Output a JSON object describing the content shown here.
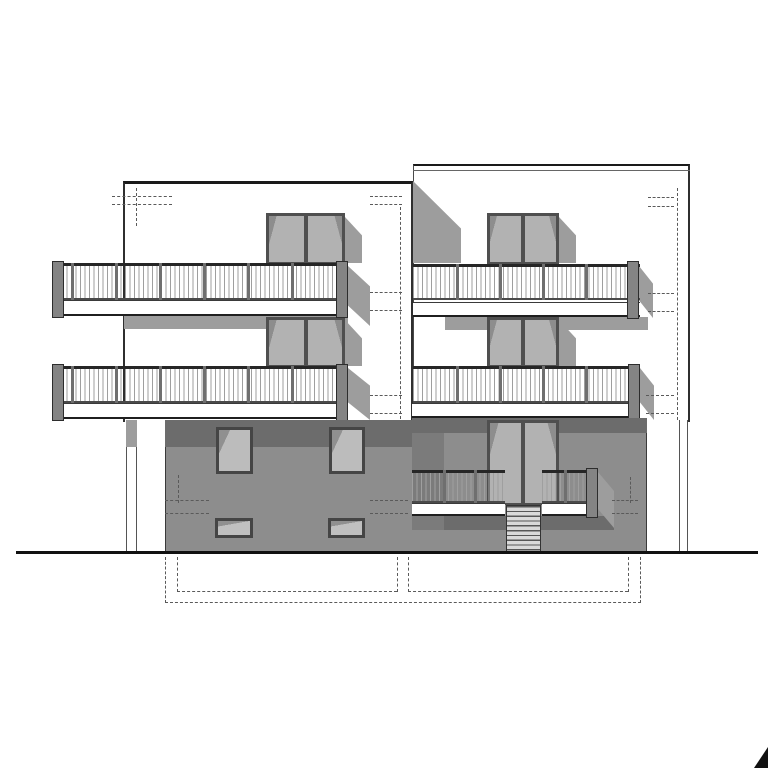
{
  "document": {
    "type": "architectural-elevation-drawing",
    "description": "Black-and-white front elevation of a three-storey duplex building: two white upper volumes with continuous balconies and double doors, a recessed gray ground storey with windows, central entrance stair with railings, cast shadows, dashed hidden-line marks, ground line and dashed basement outline, black corner mark bottom-right.",
    "visible_text": []
  },
  "colors": {
    "background": "#ffffff",
    "line": "#1a1a1a",
    "shadow": "#9d9d9d",
    "shadow_dark": "#6c6c6c",
    "wall_gray": "#8d8d8d",
    "glass_gray": "#b8b8b8",
    "frame_gray": "#4f4f4f"
  },
  "inventory": {
    "volumes": 2,
    "balcony_doors": 4,
    "entrance_doors": 1,
    "balconies": 4,
    "ground_windows": 4,
    "stair_steps": 10,
    "support_columns": 2
  },
  "scene": [
    {
      "name": "right-facade",
      "cls": "facade-right",
      "rect": [
        413,
        164,
        277,
        258
      ]
    },
    {
      "name": "right-parapet-line",
      "cls": "hline1",
      "rect": [
        413,
        170,
        277,
        0
      ]
    },
    {
      "name": "left-facade",
      "cls": "facade-left",
      "rect": [
        123,
        181,
        290,
        241
      ]
    },
    {
      "name": "volume-joint-shadow",
      "cls": "shadow9 clipJoint",
      "rect": [
        413,
        181,
        48,
        82
      ]
    },
    {
      "name": "underbalcony-shadow-2f-left",
      "cls": "shadow9",
      "rect": [
        124,
        316,
        224,
        13
      ]
    },
    {
      "name": "underbalcony-shadow-2f-right",
      "cls": "shadow9",
      "rect": [
        445,
        317,
        203,
        13
      ]
    },
    {
      "name": "door-shadow-2f-left",
      "cls": "shadow9 clipA",
      "rect": [
        345,
        217,
        17,
        46
      ]
    },
    {
      "name": "door-shadow-2f-right",
      "cls": "shadow9 clipA",
      "rect": [
        559,
        217,
        17,
        46
      ]
    },
    {
      "name": "door-shadow-1f-left",
      "cls": "shadow9 clipA",
      "rect": [
        345,
        320,
        17,
        46
      ]
    },
    {
      "name": "door-shadow-1f-right",
      "cls": "shadow9 clipA",
      "rect": [
        559,
        320,
        17,
        46
      ]
    },
    {
      "name": "balcony-door-2f-left",
      "cls": "door",
      "rect": [
        266,
        213,
        79,
        51
      ]
    },
    {
      "name": "balcony-door-2f-right",
      "cls": "door",
      "rect": [
        487,
        213,
        72,
        51
      ]
    },
    {
      "name": "balcony-door-1f-left",
      "cls": "door",
      "rect": [
        266,
        317,
        79,
        50
      ]
    },
    {
      "name": "balcony-door-1f-right",
      "cls": "door",
      "rect": [
        487,
        317,
        72,
        50
      ]
    },
    {
      "name": "balcony-end-shadow-2f-left",
      "cls": "shadow9 clipB",
      "rect": [
        348,
        266,
        22,
        60
      ]
    },
    {
      "name": "balcony-end-shadow-1f-left",
      "cls": "shadow9 clipB",
      "rect": [
        348,
        368,
        22,
        52
      ]
    },
    {
      "name": "balcony-end-shadow-2f-right",
      "cls": "shadow9 clipB",
      "rect": [
        639,
        266,
        14,
        52
      ]
    },
    {
      "name": "balcony-end-shadow-1f-right",
      "cls": "shadow9 clipB",
      "rect": [
        640,
        368,
        14,
        52
      ]
    },
    {
      "name": "balcony-fascia-2f-left",
      "cls": "fascia",
      "rect": [
        53,
        300,
        295,
        16
      ]
    },
    {
      "name": "balcony-railing-2f-left",
      "cls": "railing",
      "rect": [
        53,
        263,
        295,
        37
      ]
    },
    {
      "name": "railing-post",
      "cls": "post",
      "rect": [
        71,
        263,
        3,
        37
      ]
    },
    {
      "name": "railing-post",
      "cls": "post",
      "rect": [
        115,
        263,
        3,
        37
      ]
    },
    {
      "name": "railing-post",
      "cls": "post",
      "rect": [
        159,
        263,
        3,
        37
      ]
    },
    {
      "name": "railing-post",
      "cls": "post",
      "rect": [
        203,
        263,
        3,
        37
      ]
    },
    {
      "name": "railing-post",
      "cls": "post",
      "rect": [
        247,
        263,
        3,
        37
      ]
    },
    {
      "name": "railing-post",
      "cls": "post",
      "rect": [
        291,
        263,
        3,
        37
      ]
    },
    {
      "name": "balcony-endpost-2f-left-a",
      "cls": "endpost",
      "rect": [
        52,
        261,
        12,
        57
      ]
    },
    {
      "name": "balcony-endpost-2f-left-b",
      "cls": "endpost",
      "rect": [
        336,
        261,
        12,
        57
      ]
    },
    {
      "name": "balcony-fascia-1f-left",
      "cls": "fascia",
      "rect": [
        53,
        403,
        295,
        16
      ]
    },
    {
      "name": "balcony-railing-1f-left",
      "cls": "railing",
      "rect": [
        53,
        366,
        295,
        37
      ]
    },
    {
      "name": "railing-post",
      "cls": "post",
      "rect": [
        71,
        366,
        3,
        37
      ]
    },
    {
      "name": "railing-post",
      "cls": "post",
      "rect": [
        115,
        366,
        3,
        37
      ]
    },
    {
      "name": "railing-post",
      "cls": "post",
      "rect": [
        159,
        366,
        3,
        37
      ]
    },
    {
      "name": "railing-post",
      "cls": "post",
      "rect": [
        203,
        366,
        3,
        37
      ]
    },
    {
      "name": "railing-post",
      "cls": "post",
      "rect": [
        247,
        366,
        3,
        37
      ]
    },
    {
      "name": "railing-post",
      "cls": "post",
      "rect": [
        291,
        366,
        3,
        37
      ]
    },
    {
      "name": "balcony-endpost-1f-left-a",
      "cls": "endpost",
      "rect": [
        52,
        364,
        12,
        57
      ]
    },
    {
      "name": "balcony-endpost-1f-left-b",
      "cls": "endpost",
      "rect": [
        336,
        364,
        12,
        57
      ]
    },
    {
      "name": "balcony-fascia-2f-right",
      "cls": "fascia",
      "rect": [
        413,
        302,
        227,
        15
      ]
    },
    {
      "name": "balcony-railing-2f-right",
      "cls": "railing",
      "rect": [
        413,
        264,
        227,
        36
      ]
    },
    {
      "name": "railing-post",
      "cls": "post",
      "rect": [
        456,
        264,
        3,
        36
      ]
    },
    {
      "name": "railing-post",
      "cls": "post",
      "rect": [
        499,
        264,
        3,
        36
      ]
    },
    {
      "name": "railing-post",
      "cls": "post",
      "rect": [
        542,
        264,
        3,
        36
      ]
    },
    {
      "name": "railing-post",
      "cls": "post",
      "rect": [
        585,
        264,
        3,
        36
      ]
    },
    {
      "name": "balcony-endpost-2f-right",
      "cls": "endpost",
      "rect": [
        627,
        261,
        12,
        58
      ]
    },
    {
      "name": "balcony-fascia-1f-right",
      "cls": "fascia",
      "rect": [
        412,
        403,
        228,
        15
      ]
    },
    {
      "name": "balcony-railing-1f-right",
      "cls": "railing",
      "rect": [
        413,
        366,
        227,
        37
      ]
    },
    {
      "name": "railing-post",
      "cls": "post",
      "rect": [
        456,
        366,
        3,
        37
      ]
    },
    {
      "name": "railing-post",
      "cls": "post",
      "rect": [
        499,
        366,
        3,
        37
      ]
    },
    {
      "name": "railing-post",
      "cls": "post",
      "rect": [
        542,
        366,
        3,
        37
      ]
    },
    {
      "name": "railing-post",
      "cls": "post",
      "rect": [
        585,
        366,
        3,
        37
      ]
    },
    {
      "name": "balcony-endpost-1f-right",
      "cls": "endpost",
      "rect": [
        628,
        364,
        12,
        57
      ]
    },
    {
      "name": "ground-wall-left",
      "cls": "wallgray edgeL",
      "rect": [
        165,
        420,
        247,
        133
      ]
    },
    {
      "name": "ground-wall-left-shadowband",
      "cls": "banddark",
      "rect": [
        165,
        420,
        247,
        27
      ]
    },
    {
      "name": "support-column-left",
      "cls": "column",
      "rect": [
        126,
        420,
        11,
        133
      ]
    },
    {
      "name": "support-column-shadow",
      "cls": "shadow9",
      "rect": [
        126,
        420,
        11,
        27
      ]
    },
    {
      "name": "ground-wall-right",
      "cls": "wallgray edgeR",
      "rect": [
        412,
        418,
        235,
        135
      ]
    },
    {
      "name": "ground-wall-right-shadowband",
      "cls": "banddark",
      "rect": [
        412,
        418,
        235,
        15
      ]
    },
    {
      "name": "ground-wall-right-sidestrip",
      "cls": "bandmid",
      "rect": [
        412,
        433,
        32,
        97
      ]
    },
    {
      "name": "underlanding-shadow",
      "cls": "banddark",
      "rect": [
        444,
        516,
        170,
        14
      ]
    },
    {
      "name": "ground-window-left-a",
      "cls": "window",
      "rect": [
        216,
        427,
        37,
        47
      ]
    },
    {
      "name": "ground-window-left-b",
      "cls": "window",
      "rect": [
        329,
        427,
        36,
        47
      ]
    },
    {
      "name": "basement-window-left-a",
      "cls": "windowsm",
      "rect": [
        215,
        518,
        38,
        20
      ]
    },
    {
      "name": "basement-window-left-b",
      "cls": "windowsm",
      "rect": [
        328,
        518,
        37,
        20
      ]
    },
    {
      "name": "entrance-door",
      "cls": "door",
      "rect": [
        487,
        420,
        72,
        85
      ]
    },
    {
      "name": "entrance-stairs",
      "cls": "stairs",
      "rect": [
        506,
        505,
        35,
        48
      ]
    },
    {
      "name": "entry-fascia-left",
      "cls": "fascia",
      "rect": [
        412,
        503,
        93,
        13
      ]
    },
    {
      "name": "entry-railing-left",
      "cls": "railing",
      "rect": [
        412,
        470,
        93,
        33
      ]
    },
    {
      "name": "railing-post",
      "cls": "post",
      "rect": [
        443,
        470,
        3,
        33
      ]
    },
    {
      "name": "railing-post",
      "cls": "post",
      "rect": [
        474,
        470,
        3,
        33
      ]
    },
    {
      "name": "entry-fascia-right",
      "cls": "fascia",
      "rect": [
        542,
        503,
        56,
        13
      ]
    },
    {
      "name": "entry-railing-right",
      "cls": "railing",
      "rect": [
        542,
        470,
        56,
        33
      ]
    },
    {
      "name": "railing-post",
      "cls": "post",
      "rect": [
        564,
        470,
        3,
        33
      ]
    },
    {
      "name": "entry-endpost",
      "cls": "endpost",
      "rect": [
        586,
        468,
        12,
        50
      ]
    },
    {
      "name": "entry-end-shadow",
      "cls": "shadow9 clipB",
      "rect": [
        598,
        472,
        16,
        56
      ]
    },
    {
      "name": "ground-column-right",
      "cls": "column",
      "rect": [
        679,
        420,
        9,
        132
      ]
    },
    {
      "name": "hidden-line-mark",
      "cls": "dashh",
      "rect": [
        112,
        196,
        60,
        0
      ]
    },
    {
      "name": "hidden-line-mark",
      "cls": "dashh",
      "rect": [
        112,
        204,
        60,
        0
      ]
    },
    {
      "name": "hidden-line-mark",
      "cls": "dashv",
      "rect": [
        136,
        188,
        0,
        38
      ]
    },
    {
      "name": "hidden-line-mark",
      "cls": "dashh",
      "rect": [
        370,
        196,
        32,
        0
      ]
    },
    {
      "name": "hidden-line-mark",
      "cls": "dashh",
      "rect": [
        370,
        204,
        32,
        0
      ]
    },
    {
      "name": "hidden-line-mark",
      "cls": "dashv",
      "rect": [
        400,
        207,
        0,
        212
      ]
    },
    {
      "name": "hidden-line-mark",
      "cls": "dashh",
      "rect": [
        370,
        292,
        32,
        0
      ]
    },
    {
      "name": "hidden-line-mark",
      "cls": "dashh",
      "rect": [
        370,
        310,
        32,
        0
      ]
    },
    {
      "name": "hidden-line-mark",
      "cls": "dashh",
      "rect": [
        370,
        395,
        32,
        0
      ]
    },
    {
      "name": "hidden-line-mark",
      "cls": "dashh",
      "rect": [
        370,
        413,
        32,
        0
      ]
    },
    {
      "name": "hidden-line-mark",
      "cls": "dashh",
      "rect": [
        648,
        197,
        26,
        0
      ]
    },
    {
      "name": "hidden-line-mark",
      "cls": "dashh",
      "rect": [
        648,
        206,
        26,
        0
      ]
    },
    {
      "name": "hidden-line-mark",
      "cls": "dashv",
      "rect": [
        677,
        188,
        0,
        232
      ]
    },
    {
      "name": "hidden-line-mark",
      "cls": "dashh",
      "rect": [
        648,
        293,
        26,
        0
      ]
    },
    {
      "name": "hidden-line-mark",
      "cls": "dashh",
      "rect": [
        648,
        311,
        26,
        0
      ]
    },
    {
      "name": "hidden-line-mark",
      "cls": "dashh",
      "rect": [
        646,
        395,
        28,
        0
      ]
    },
    {
      "name": "hidden-line-mark",
      "cls": "dashh",
      "rect": [
        646,
        413,
        28,
        0
      ]
    },
    {
      "name": "hidden-line-mark",
      "cls": "dashh",
      "rect": [
        165,
        500,
        44,
        0
      ]
    },
    {
      "name": "hidden-line-mark",
      "cls": "dashh",
      "rect": [
        165,
        513,
        44,
        0
      ]
    },
    {
      "name": "hidden-line-mark",
      "cls": "dashv",
      "rect": [
        178,
        475,
        0,
        28
      ]
    },
    {
      "name": "hidden-line-mark",
      "cls": "dashh",
      "rect": [
        370,
        500,
        38,
        0
      ]
    },
    {
      "name": "hidden-line-mark",
      "cls": "dashh",
      "rect": [
        370,
        513,
        38,
        0
      ]
    },
    {
      "name": "hidden-line-mark",
      "cls": "dashh",
      "rect": [
        612,
        500,
        26,
        0
      ]
    },
    {
      "name": "hidden-line-mark",
      "cls": "dashh",
      "rect": [
        612,
        513,
        26,
        0
      ]
    },
    {
      "name": "hidden-line-mark",
      "cls": "dashv",
      "rect": [
        630,
        477,
        0,
        26
      ]
    },
    {
      "name": "ground-line",
      "cls": "groundline",
      "rect": [
        16,
        551,
        742,
        0
      ]
    },
    {
      "name": "basement-outline",
      "cls": "dashv",
      "rect": [
        165,
        557,
        0,
        46
      ]
    },
    {
      "name": "basement-outline",
      "cls": "dashv",
      "rect": [
        177,
        557,
        0,
        35
      ]
    },
    {
      "name": "basement-outline",
      "cls": "dashv",
      "rect": [
        397,
        557,
        0,
        35
      ]
    },
    {
      "name": "basement-outline",
      "cls": "dashv",
      "rect": [
        408,
        557,
        0,
        35
      ]
    },
    {
      "name": "basement-outline",
      "cls": "dashv",
      "rect": [
        628,
        557,
        0,
        35
      ]
    },
    {
      "name": "basement-outline",
      "cls": "dashv",
      "rect": [
        640,
        557,
        0,
        46
      ]
    },
    {
      "name": "basement-outline",
      "cls": "dashh",
      "rect": [
        177,
        591,
        220,
        0
      ]
    },
    {
      "name": "basement-outline",
      "cls": "dashh",
      "rect": [
        408,
        591,
        220,
        0
      ]
    },
    {
      "name": "basement-outline",
      "cls": "dashh",
      "rect": [
        165,
        602,
        476,
        0
      ]
    },
    {
      "name": "corner-mark-triangle",
      "cls": "tri",
      "rect": [
        754,
        747,
        14,
        21
      ]
    }
  ]
}
